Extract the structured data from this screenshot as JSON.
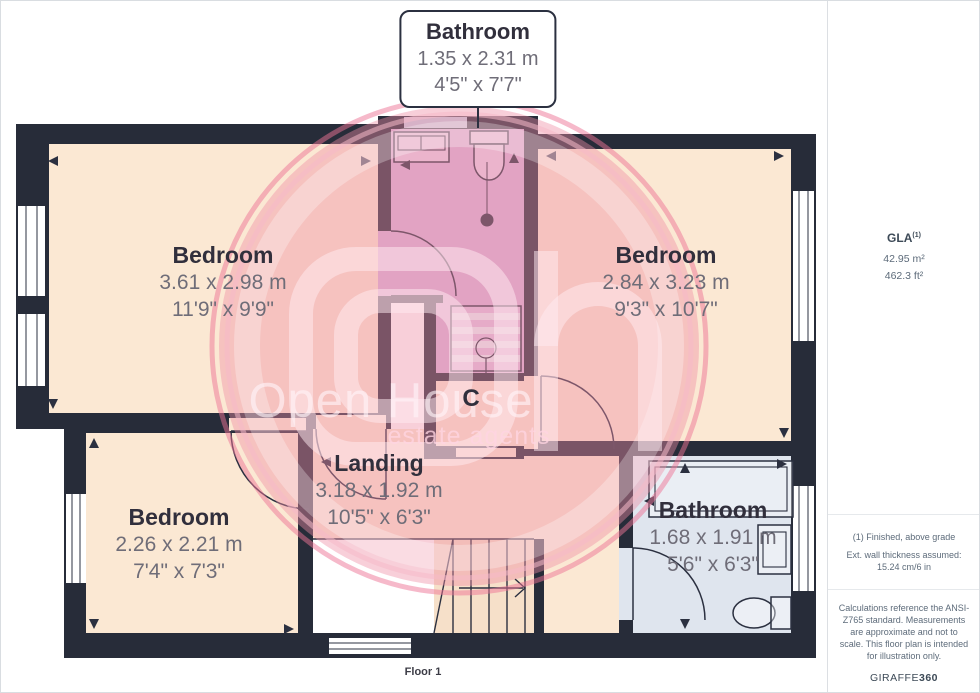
{
  "callout": {
    "room": "Bathroom",
    "metric": "1.35 x 2.31 m",
    "imperial": "4'5\" x 7'7\""
  },
  "rooms": [
    {
      "id": "bedroom-top-left",
      "name": "Bedroom",
      "metric": "3.61 x 2.98 m",
      "imperial": "11'9\" x 9'9\""
    },
    {
      "id": "bedroom-top-right",
      "name": "Bedroom",
      "metric": "2.84 x 3.23 m",
      "imperial": "9'3\" x 10'7\""
    },
    {
      "id": "bedroom-bottom-left",
      "name": "Bedroom",
      "metric": "2.26 x 2.21 m",
      "imperial": "7'4\" x 7'3\""
    },
    {
      "id": "landing",
      "name": "Landing",
      "metric": "3.18 x 1.92 m",
      "imperial": "10'5\" x 6'3\""
    },
    {
      "id": "bathroom-bottom-right",
      "name": "Bathroom",
      "metric": "1.68 x 1.91 m",
      "imperial": "5'6\" x 6'3\""
    }
  ],
  "closet_label": "C",
  "floor_label": "Floor 1",
  "watermark": {
    "line1": "Open House",
    "line2": "estate agents"
  },
  "sidebar": {
    "gla_label": "GLA",
    "gla_superscript": "(1)",
    "area_metric": "42.95 m²",
    "area_imperial": "462.3 ft²",
    "note1": "(1) Finished, above grade",
    "note2": "Ext. wall thickness assumed: 15.24 cm/6 in",
    "disclaimer": "Calculations reference the ANSI-Z765 standard. Measurements are approximate and not to scale. This floor plan is intended for illustration only.",
    "brand_regular": "GIRAFFE",
    "brand_bold": "360"
  },
  "colors": {
    "wall": "#272c39",
    "room_floor": "#fbe8d3",
    "bathroom_floor": "#d9b3da",
    "bathroom2_floor": "#dfe5ee",
    "watermark_pink": "#ef8ca4"
  }
}
